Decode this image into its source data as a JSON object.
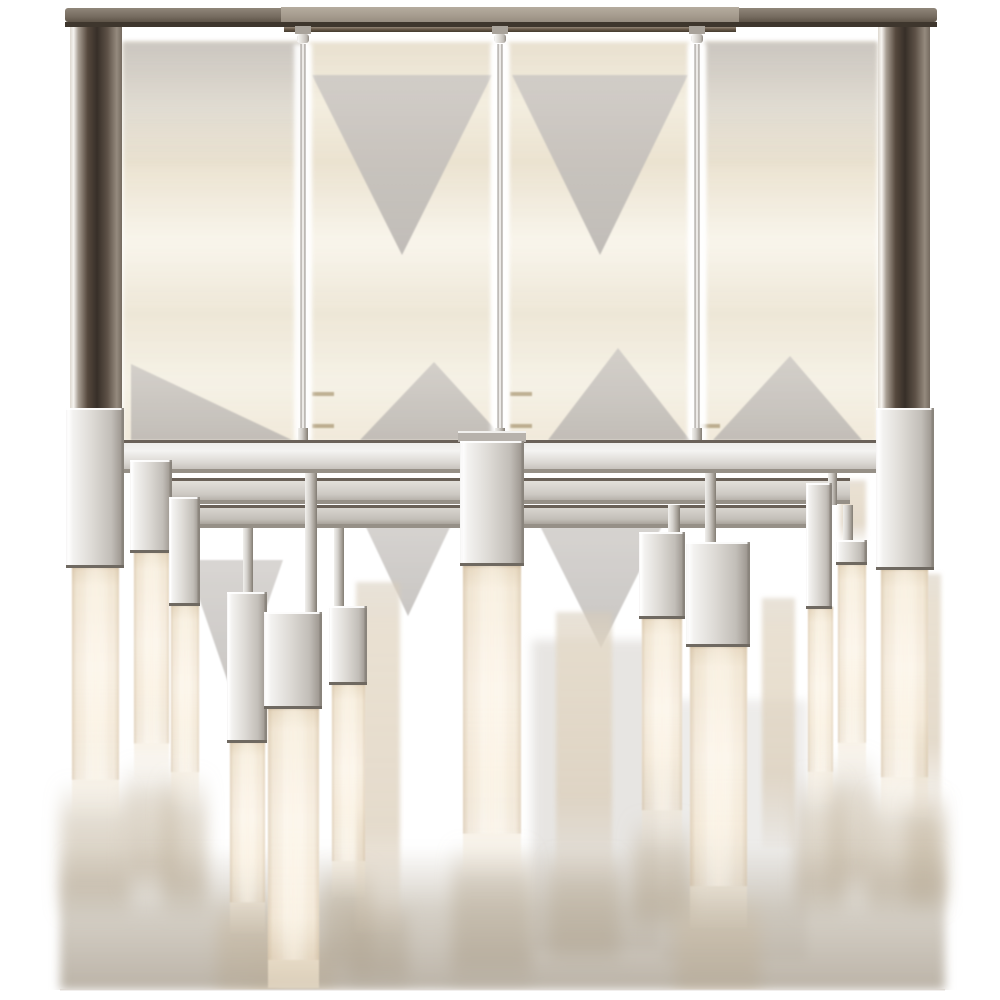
{
  "meta": {
    "alt": "Product photograph of a polished nickel linear chandelier with rectangular frame and glowing alabaster rod lights hanging at staggered heights, on a white background with soft scan artifacts"
  },
  "palette": {
    "background": "#ffffff",
    "nickel_light": "#f3f2f0",
    "nickel_mid": "#d8d5d0",
    "nickel_dark": "#8a847c",
    "post_dark": "#372f28",
    "canopy_grey": "#a79d90",
    "canopy_side": "#766c60",
    "canopy_line_dark": "#3e362d",
    "alabaster_core": "#fbf4e8",
    "alabaster_edge": "#c9b79c",
    "artifact_tan": "#e2d5ba",
    "artifact_grey": "#c7c3bf",
    "smear_taupe": "#b3a998",
    "dash_gold": "#7d6431",
    "bottom_edge": "#dcd6cf"
  },
  "scene": {
    "canopy": {
      "bar": {
        "x": 65,
        "y": 8,
        "w": 872,
        "h": 14
      },
      "center": {
        "x": 281,
        "y": 7,
        "w": 458,
        "h": 16
      },
      "darkline": {
        "x": 65,
        "y": 22,
        "w": 872,
        "h": 5
      },
      "lip": {
        "x": 284,
        "y": 27,
        "w": 452,
        "h": 5
      }
    },
    "posts": [
      {
        "x": 70,
        "y": 14,
        "w": 52,
        "h": 396
      },
      {
        "x": 878,
        "y": 14,
        "w": 52,
        "h": 396
      }
    ],
    "stems": {
      "centers": [
        303,
        500,
        697
      ],
      "rod": {
        "y1": 44,
        "y2": 441,
        "w": 5
      },
      "collar": {
        "y": 26,
        "w": 16,
        "h": 8
      },
      "ball": {
        "y": 34,
        "w": 12,
        "h": 9
      },
      "nub": {
        "y": 428,
        "w": 10,
        "h": 13
      },
      "halo_w": 18
    },
    "rails": {
      "front": {
        "x": 102,
        "y": 440,
        "w": 796,
        "h": 33
      },
      "mid": {
        "x": 150,
        "y": 478,
        "w": 700,
        "h": 26
      },
      "rear": {
        "x": 175,
        "y": 505,
        "w": 650,
        "h": 23
      }
    },
    "straps": [
      {
        "x": 305,
        "y": 473,
        "w": 12,
        "h": 140
      },
      {
        "x": 243,
        "y": 528,
        "w": 10,
        "h": 66
      },
      {
        "x": 334,
        "y": 528,
        "w": 10,
        "h": 80
      },
      {
        "x": 705,
        "y": 473,
        "w": 11,
        "h": 70
      },
      {
        "x": 668,
        "y": 505,
        "w": 12,
        "h": 28
      },
      {
        "x": 843,
        "y": 505,
        "w": 10,
        "h": 36
      },
      {
        "x": 163,
        "y": 473,
        "w": 9,
        "h": 32
      },
      {
        "x": 828,
        "y": 473,
        "w": 9,
        "h": 32
      }
    ],
    "lights": [
      {
        "name": "corner-left",
        "block": {
          "x": 66,
          "y": 408,
          "w": 58,
          "h": 160
        },
        "rod": {
          "x": 72,
          "y": 566,
          "w": 47,
          "h": 252,
          "fade": 0.62
        }
      },
      {
        "name": "left-2",
        "block": {
          "x": 130,
          "y": 460,
          "w": 42,
          "h": 93
        },
        "rod": {
          "x": 134,
          "y": 551,
          "w": 35,
          "h": 229,
          "fade": 0.6
        }
      },
      {
        "name": "left-3",
        "block": {
          "x": 169,
          "y": 497,
          "w": 31,
          "h": 109
        },
        "rod": {
          "x": 171,
          "y": 604,
          "w": 28,
          "h": 202,
          "fade": 0.58
        }
      },
      {
        "name": "left-4",
        "block": {
          "x": 227,
          "y": 592,
          "w": 40,
          "h": 151
        },
        "rod": {
          "x": 230,
          "y": 741,
          "w": 35,
          "h": 192,
          "fade": 0.6
        }
      },
      {
        "name": "left-5",
        "block": {
          "x": 264,
          "y": 612,
          "w": 58,
          "h": 97
        },
        "rod": {
          "x": 268,
          "y": 707,
          "w": 51,
          "h": 281,
          "fade": 0.75
        }
      },
      {
        "name": "left-6",
        "block": {
          "x": 329,
          "y": 606,
          "w": 38,
          "h": 79
        },
        "rod": {
          "x": 332,
          "y": 683,
          "w": 33,
          "h": 214,
          "fade": 0.58
        }
      },
      {
        "name": "center",
        "cap": {
          "x": 458,
          "y": 431,
          "w": 68,
          "h": 11
        },
        "block": {
          "x": 460,
          "y": 441,
          "w": 64,
          "h": 125
        },
        "rod": {
          "x": 463,
          "y": 564,
          "w": 58,
          "h": 312,
          "fade": 0.66
        }
      },
      {
        "name": "right-1",
        "block": {
          "x": 639,
          "y": 532,
          "w": 46,
          "h": 87
        },
        "rod": {
          "x": 642,
          "y": 617,
          "w": 40,
          "h": 230,
          "fade": 0.6
        }
      },
      {
        "name": "right-2",
        "block": {
          "x": 686,
          "y": 542,
          "w": 64,
          "h": 105
        },
        "rod": {
          "x": 690,
          "y": 645,
          "w": 57,
          "h": 283,
          "fade": 0.63
        }
      },
      {
        "name": "right-3",
        "block": {
          "x": 806,
          "y": 483,
          "w": 26,
          "h": 126
        },
        "rod": {
          "x": 808,
          "y": 607,
          "w": 25,
          "h": 198,
          "fade": 0.58
        }
      },
      {
        "name": "right-4",
        "block": {
          "x": 836,
          "y": 540,
          "w": 31,
          "h": 25
        },
        "rod": {
          "x": 838,
          "y": 563,
          "w": 28,
          "h": 216,
          "fade": 0.58
        }
      },
      {
        "name": "corner-right",
        "block": {
          "x": 876,
          "y": 408,
          "w": 58,
          "h": 162
        },
        "rod": {
          "x": 881,
          "y": 568,
          "w": 47,
          "h": 249,
          "fade": 0.6
        }
      }
    ],
    "rear_rods": [
      {
        "x": 356,
        "y": 582,
        "w": 44,
        "h": 350
      },
      {
        "x": 556,
        "y": 612,
        "w": 56,
        "h": 264
      },
      {
        "x": 762,
        "y": 598,
        "w": 33,
        "h": 250
      },
      {
        "x": 914,
        "y": 574,
        "w": 27,
        "h": 240
      },
      {
        "x": 840,
        "y": 480,
        "w": 26,
        "h": 62
      }
    ],
    "artifacts": {
      "bands": [
        {
          "x": 123,
          "y": 42,
          "w": 179,
          "h": 400
        },
        {
          "x": 309,
          "y": 42,
          "w": 183,
          "h": 400
        },
        {
          "x": 508,
          "y": 42,
          "w": 181,
          "h": 400
        },
        {
          "x": 705,
          "y": 42,
          "w": 172,
          "h": 400
        }
      ],
      "top_grey_bands": [
        {
          "x": 123,
          "y": 42,
          "w": 179,
          "h": 130
        },
        {
          "x": 705,
          "y": 42,
          "w": 172,
          "h": 130
        }
      ],
      "top_triangles": [
        {
          "pts": "312,75 492,75 402,255"
        },
        {
          "pts": "512,75 688,75 600,255"
        }
      ],
      "bottom_triangles": [
        {
          "pts": "131,364 131,440 292,440"
        },
        {
          "pts": "360,440 505,440 434,362"
        },
        {
          "pts": "548,440 690,440 618,348"
        },
        {
          "pts": "713,440 862,440 790,356"
        }
      ],
      "under_frame_triangles": [
        {
          "pts": "356,506 460,506 408,616"
        },
        {
          "pts": "530,506 672,506 601,648"
        },
        {
          "pts": "186,560 283,560 234,700"
        }
      ],
      "grey_bands_low": [
        {
          "x": 532,
          "y": 640,
          "w": 128,
          "h": 310,
          "op": 0.35
        },
        {
          "x": 662,
          "y": 700,
          "w": 145,
          "h": 260,
          "op": 0.25
        }
      ],
      "dashes": [
        {
          "x": 312,
          "y": 392,
          "w": 22,
          "h": 4
        },
        {
          "x": 510,
          "y": 392,
          "w": 22,
          "h": 4
        },
        {
          "x": 312,
          "y": 424,
          "w": 22,
          "h": 4
        },
        {
          "x": 510,
          "y": 424,
          "w": 22,
          "h": 4
        },
        {
          "x": 700,
          "y": 424,
          "w": 20,
          "h": 4
        }
      ],
      "bottom_smear": {
        "x": 60,
        "y": 845,
        "w": 885,
        "h": 145
      },
      "bottom_edge_y": 990
    },
    "plumes": [
      {
        "cx": 95,
        "w": 70,
        "y1": 780,
        "y2": 915,
        "bright": false
      },
      {
        "cx": 151,
        "w": 52,
        "y1": 760,
        "y2": 895,
        "bright": false
      },
      {
        "cx": 185,
        "w": 44,
        "y1": 770,
        "y2": 915,
        "bright": false
      },
      {
        "cx": 247,
        "w": 60,
        "y1": 900,
        "y2": 990,
        "bright": true
      },
      {
        "cx": 293,
        "w": 85,
        "y1": 940,
        "y2": 990,
        "bright": true
      },
      {
        "cx": 348,
        "w": 50,
        "y1": 860,
        "y2": 978,
        "bright": false
      },
      {
        "cx": 378,
        "w": 60,
        "y1": 900,
        "y2": 988,
        "bright": false
      },
      {
        "cx": 492,
        "w": 80,
        "y1": 840,
        "y2": 988,
        "bright": false
      },
      {
        "cx": 584,
        "w": 70,
        "y1": 850,
        "y2": 965,
        "bright": false
      },
      {
        "cx": 662,
        "w": 58,
        "y1": 815,
        "y2": 930,
        "bright": false
      },
      {
        "cx": 718,
        "w": 85,
        "y1": 895,
        "y2": 990,
        "bright": true
      },
      {
        "cx": 820,
        "w": 48,
        "y1": 770,
        "y2": 915,
        "bright": false
      },
      {
        "cx": 852,
        "w": 44,
        "y1": 750,
        "y2": 900,
        "bright": false
      },
      {
        "cx": 904,
        "w": 72,
        "y1": 785,
        "y2": 915,
        "bright": false
      },
      {
        "cx": 927,
        "w": 40,
        "y1": 790,
        "y2": 910,
        "bright": false
      }
    ]
  }
}
